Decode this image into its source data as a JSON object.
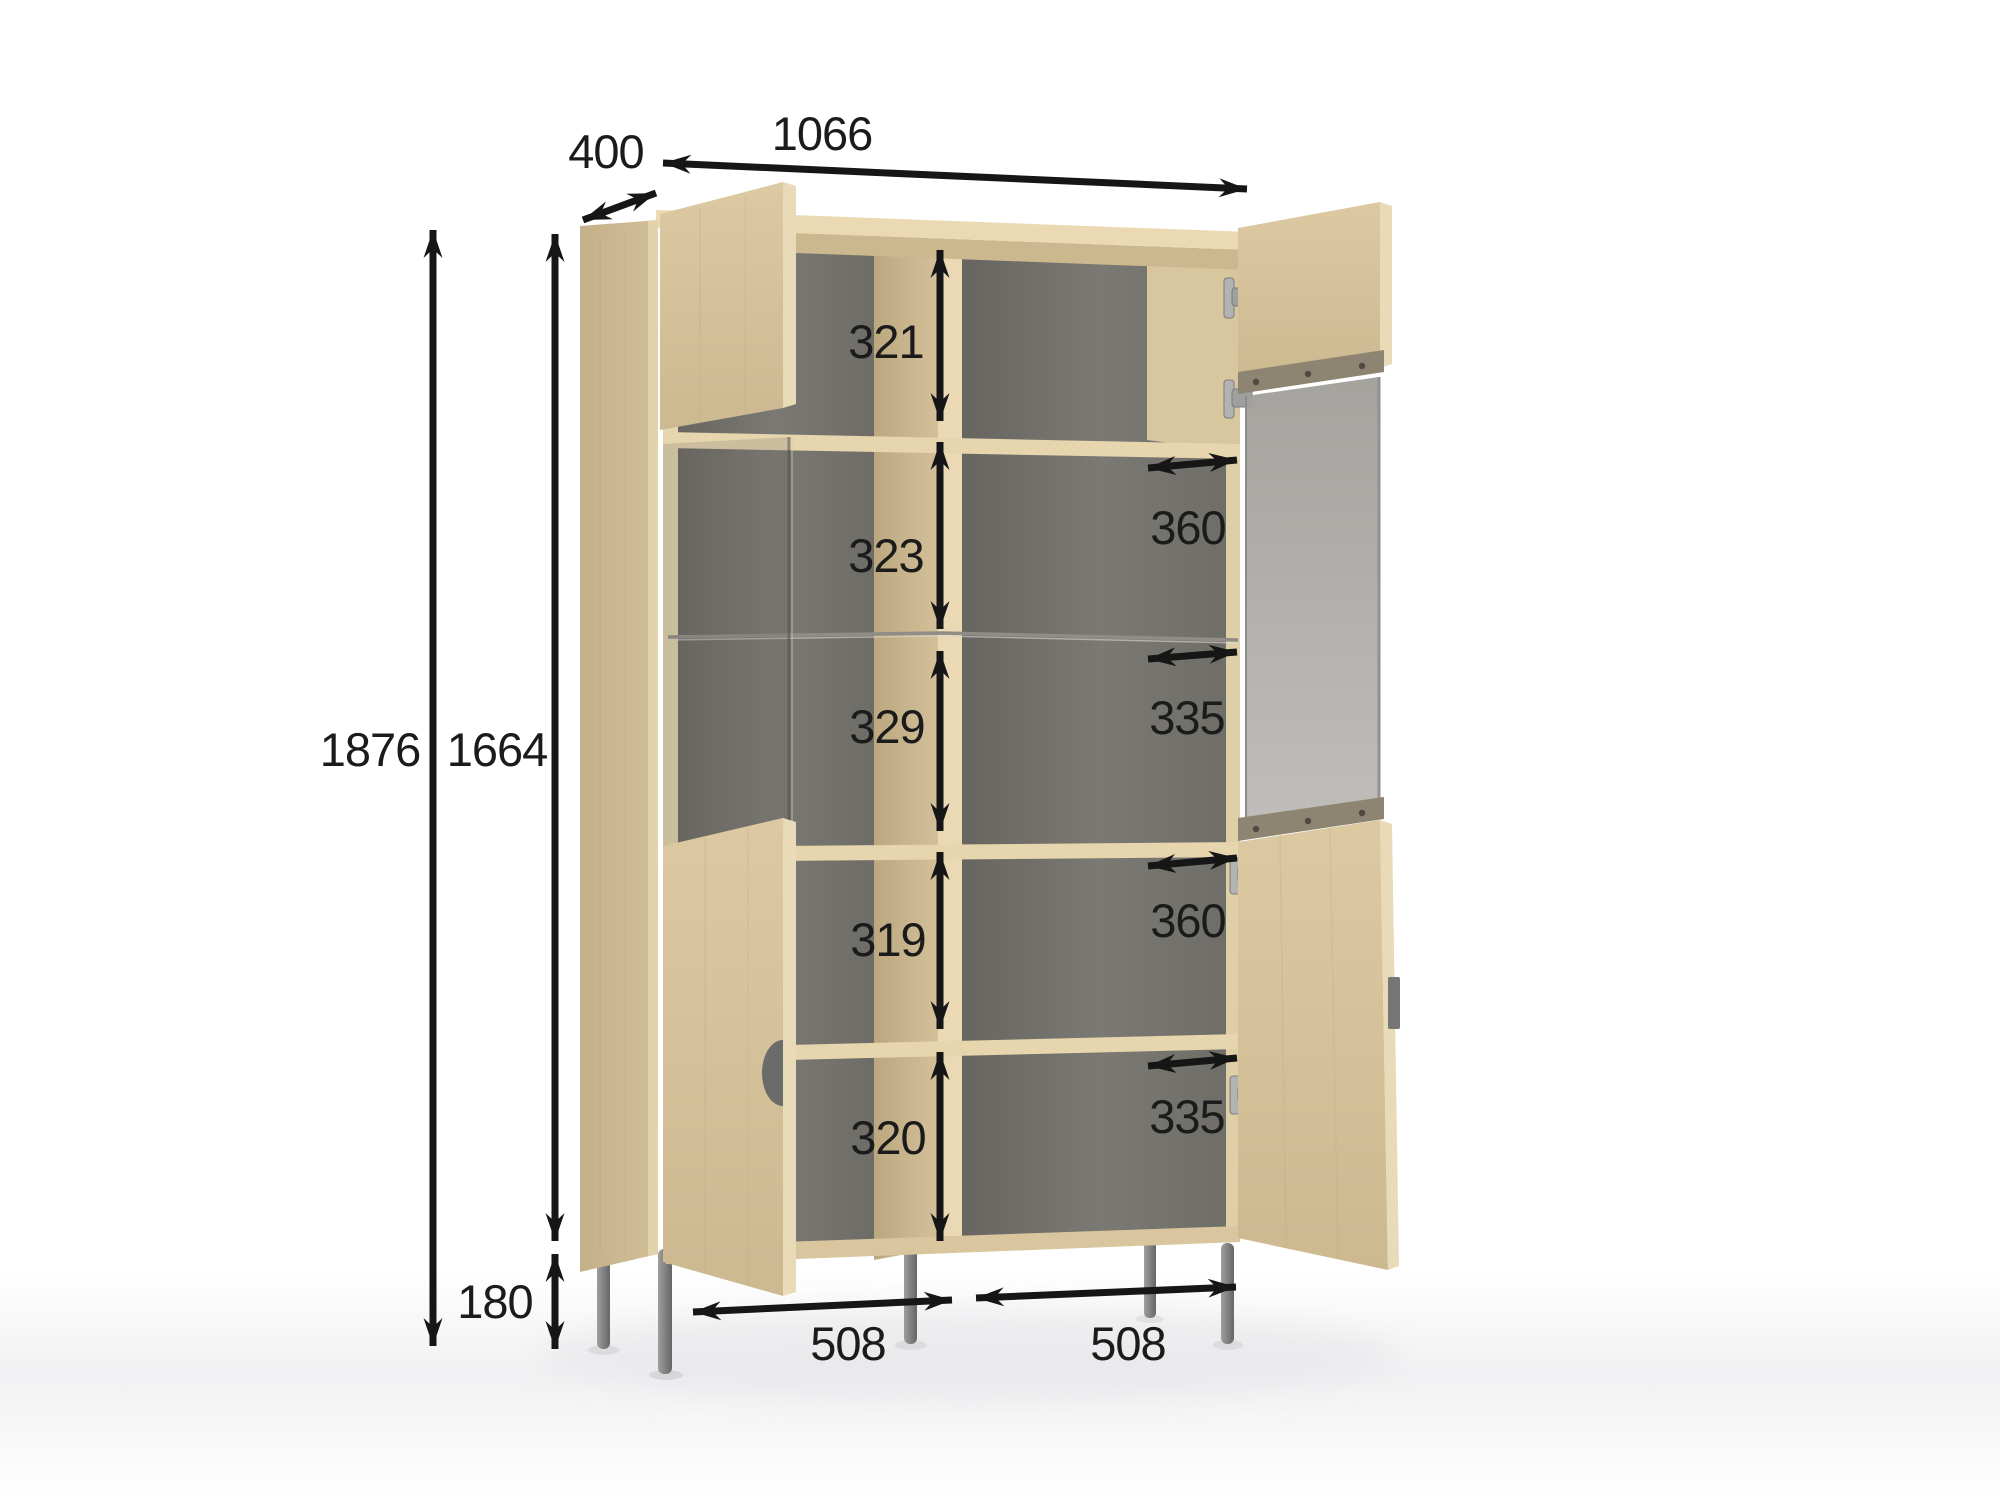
{
  "object": "cabinet-dimension-diagram",
  "dimensions": {
    "depth": "400",
    "width": "1066",
    "total_height": "1876",
    "body_height": "1664",
    "leg_height": "180",
    "compartment_heights": [
      "321",
      "323",
      "329",
      "319",
      "320"
    ],
    "compartment_widths": [
      "360",
      "335",
      "360",
      "335"
    ],
    "base_widths": [
      "508",
      "508"
    ]
  },
  "colors": {
    "arrow": "#161616",
    "label_text": "#1b1b1b",
    "wood_face": "#d5c29b",
    "wood_side": "#c9b68f",
    "wood_edge": "#ead9b4",
    "interior_back": "#716f6a",
    "glass": "#aeacaa",
    "rail": "#8d8471",
    "metal_leg": "#8a8a8a",
    "handle": "#6f6f6e"
  }
}
